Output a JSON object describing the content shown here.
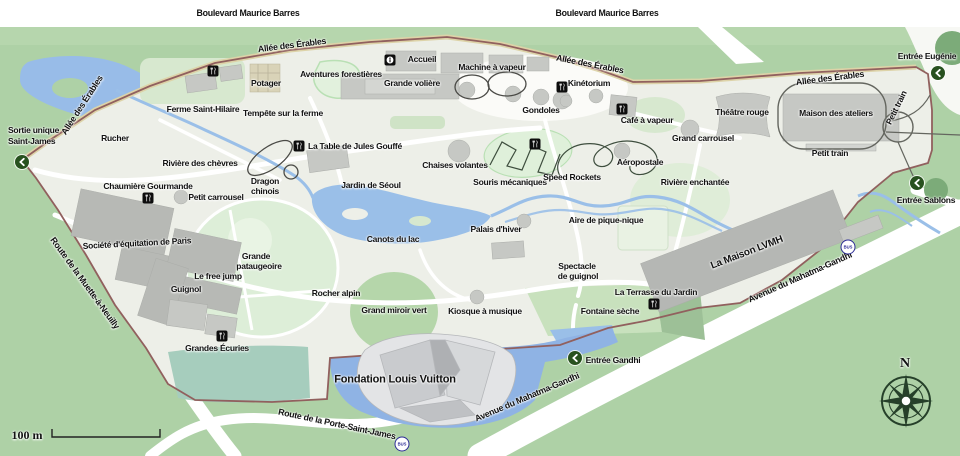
{
  "roads": {
    "boulevard": "Boulevard Maurice Barres",
    "erables": "Allée des Érables",
    "muette": "Route de la Muette-à-Neuilly",
    "porte_saint_james": "Route de la Porte-Saint-James",
    "gandhi": "Avenue du Mahatma-Gandhi",
    "petit_train": "Petit train"
  },
  "entrances": {
    "sortie_line1": "Sortie unique",
    "sortie_line2": "Saint-James",
    "eugenie": "Entrée Eugénie",
    "sablons": "Entrée Sablons",
    "gandhi": "Entrée Gandhi"
  },
  "pois": {
    "accueil": "Accueil",
    "aventures": "Aventures forestières",
    "grande_voliere": "Grande volière",
    "machine_vapeur": "Machine à vapeur",
    "gondoles": "Gondoles",
    "kinetorium": "Kinétorium",
    "cafe_vapeur": "Café à vapeur",
    "theatre_rouge": "Théâtre rouge",
    "maison_ateliers": "Maison des ateliers",
    "petit_train": "Petit train",
    "grand_carrousel": "Grand carrousel",
    "aeropostale": "Aéropostale",
    "riviere_enchantee": "Rivière enchantée",
    "potager": "Potager",
    "ferme": "Ferme Saint-Hilaire",
    "tempete": "Tempête sur la ferme",
    "rucher": "Rucher",
    "riviere_chevres": "Rivière des chèvres",
    "chaumiere": "Chaumière Gourmande",
    "petit_carrousel": "Petit carrousel",
    "dragon_line1": "Dragon",
    "dragon_line2": "chinois",
    "table_jules": "La Table de Jules Gouffé",
    "jardin_seoul": "Jardin de Séoul",
    "canots": "Canots du lac",
    "chaises": "Chaises volantes",
    "souris": "Souris mécaniques",
    "speed_rockets": "Speed Rockets",
    "palais_hiver": "Palais d'hiver",
    "pique_nique": "Aire de pique-nique",
    "spectacle_line1": "Spectacle",
    "spectacle_line2": "de guignol",
    "terrasse": "La Terrasse du Jardin",
    "fontaine": "Fontaine sèche",
    "societe": "Société d'équitation de Paris",
    "pataugeoire_line1": "Grande",
    "pataugeoire_line2": "pataugeoire",
    "free_jump": "Le free jump",
    "guignol": "Guignol",
    "grandes_ecuries": "Grandes Écuries",
    "rocher_alpin": "Rocher alpin",
    "miroir_vert": "Grand miroir vert",
    "kiosque": "Kiosque à musique",
    "fondation": "Fondation Louis Vuitton",
    "maison_lvmh": "La Maison LVMH"
  },
  "transport": {
    "bus": "BUS"
  },
  "compass": {
    "north": "N"
  },
  "scale": {
    "label": "100 m"
  },
  "icons": {
    "restaurant": "fork-knife-on-black-square",
    "information": "i-in-black-square",
    "entrance_arrow": "white-chevron-in-dark-green-circle",
    "bus": "BUS-in-navy-ring-circle",
    "compass_rose": "eight-point-star"
  },
  "colors": {
    "outside_green": "#aed1a6",
    "park_fill": "#edefe8",
    "park_boundary": "#91605e",
    "water": "#9abfe8",
    "building_gray": "#c6c8c4",
    "entrance_green": "#28511f",
    "bus_navy": "#2d2d96"
  }
}
